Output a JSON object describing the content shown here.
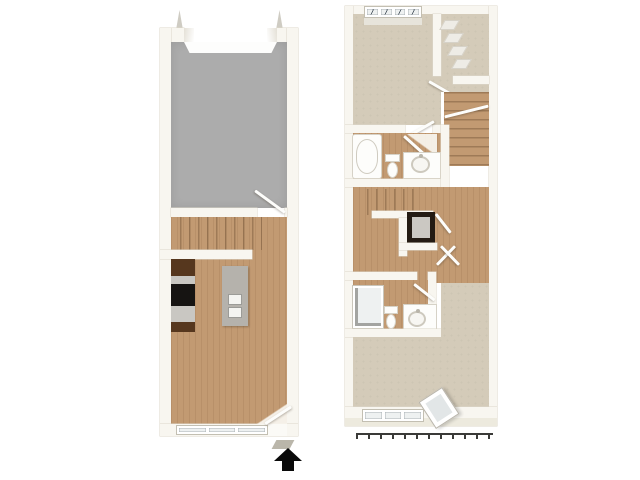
{
  "image": {
    "type": "3d-floorplan-top-down-render",
    "units": 2,
    "background": "#ffffff"
  },
  "colors": {
    "background": "#ffffff",
    "wall": "#f8f6f0",
    "wall_edge": "#dcd7ca",
    "wall_face": "#edeade",
    "wood": "#c29a72",
    "carpet": "#d4cbb9",
    "concrete": "#acacac",
    "cabinet": "#56371e",
    "appliance": "#161412",
    "counter": "#c9c7c2",
    "island": "#b5b2ac",
    "fixture_white": "#fdfdfb",
    "glass": "#eef1f1",
    "glazing_line": "#57616b",
    "washer_body": "#241b13",
    "washer_top": "#cbc8c2",
    "railing": "#3a3a38",
    "arrow": "#0a0a0a",
    "threshold": "#bab6aa"
  },
  "floor1": {
    "label": "first-floor",
    "rooms": [
      {
        "id": "garage",
        "finish": "concrete"
      },
      {
        "id": "stair-landing",
        "finish": "wood"
      },
      {
        "id": "kitchen",
        "finish": "wood"
      },
      {
        "id": "living-room",
        "finish": "wood"
      }
    ],
    "fixtures": [
      "garage-door-opening",
      "garage-entry-door",
      "staircase",
      "kitchen-counter",
      "range",
      "kitchen-island",
      "double-sink",
      "triple-window",
      "entry-door",
      "entry-arrow"
    ],
    "entry_arrow_direction": "up"
  },
  "floor2": {
    "label": "second-floor",
    "rooms": [
      {
        "id": "bedroom-1",
        "finish": "carpet"
      },
      {
        "id": "walk-in-closet",
        "finish": "carpet"
      },
      {
        "id": "bathroom-1",
        "finish": "wood"
      },
      {
        "id": "hallway",
        "finish": "wood"
      },
      {
        "id": "laundry-closet",
        "finish": "wood"
      },
      {
        "id": "bathroom-2",
        "finish": "wood"
      },
      {
        "id": "bedroom-2",
        "finish": "carpet"
      }
    ],
    "fixtures": [
      "window-band",
      "hanging-clothes",
      "staircase-upper",
      "staircase-lower",
      "bathtub",
      "toilet",
      "vanity-sink",
      "washer-dryer",
      "shower",
      "toilet",
      "vanity-sink",
      "triple-window",
      "open-casement-window",
      "balcony-railing"
    ]
  }
}
